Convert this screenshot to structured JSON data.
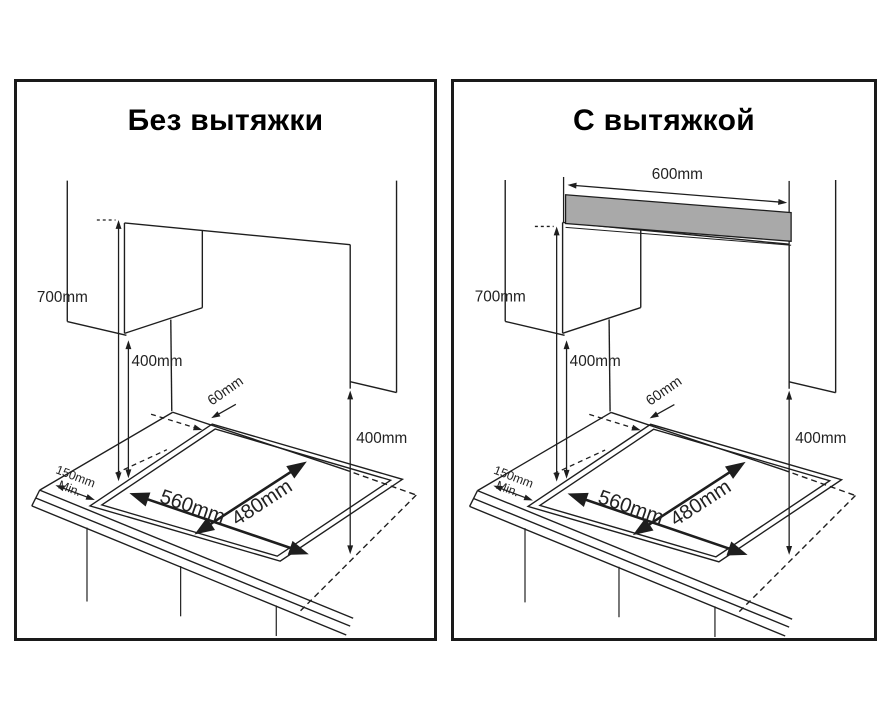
{
  "colors": {
    "line": "#1e1e1e",
    "text": "#222222",
    "hood_fill": "#a9a9a9",
    "panel_border": "#1a1a1a",
    "background": "#ffffff"
  },
  "panels": [
    {
      "id": "without-hood",
      "title": "Без вытяжки",
      "dims": {
        "height_700": "700mm",
        "height_400": "400mm",
        "gap_60": "60mm",
        "side_400": "400mm",
        "edge_min_line1": "150mm",
        "edge_min_line2": "Min.",
        "cutout_width": "560mm",
        "cutout_depth": "480mm"
      }
    },
    {
      "id": "with-hood",
      "title": "С вытяжкой",
      "dims": {
        "hood_width": "600mm",
        "height_700": "700mm",
        "height_400": "400mm",
        "gap_60": "60mm",
        "side_400": "400mm",
        "edge_min_line1": "150mm",
        "edge_min_line2": "Min.",
        "cutout_width": "560mm",
        "cutout_depth": "480mm"
      }
    }
  ]
}
